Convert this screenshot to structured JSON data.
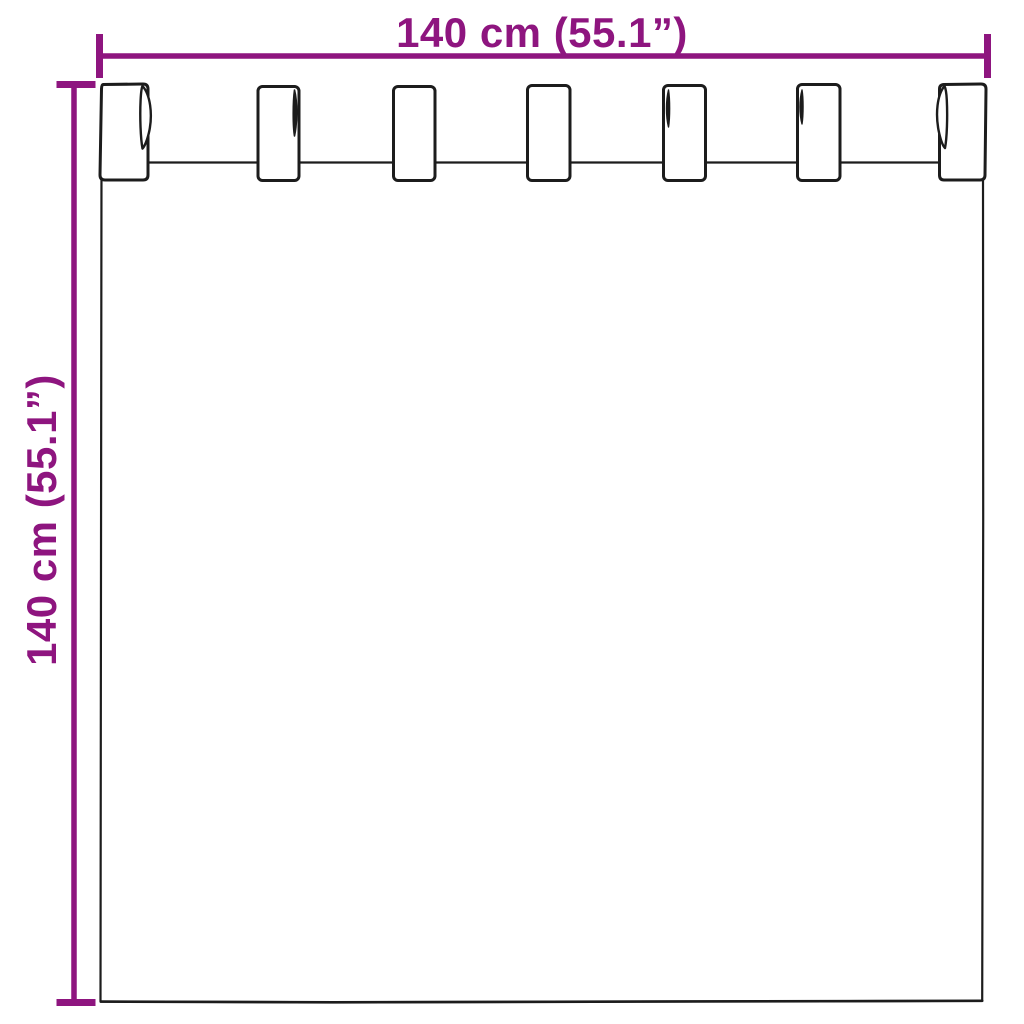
{
  "diagram": {
    "type": "product dimension diagram",
    "subject": "tab top curtain",
    "tab_count": 7,
    "width_label": "140 cm (55.1”)",
    "height_label": "140 cm (55.1”)"
  },
  "colors": {
    "dimension": "#8E157F",
    "outline": "#1c1c1c",
    "background": "#ffffff"
  }
}
